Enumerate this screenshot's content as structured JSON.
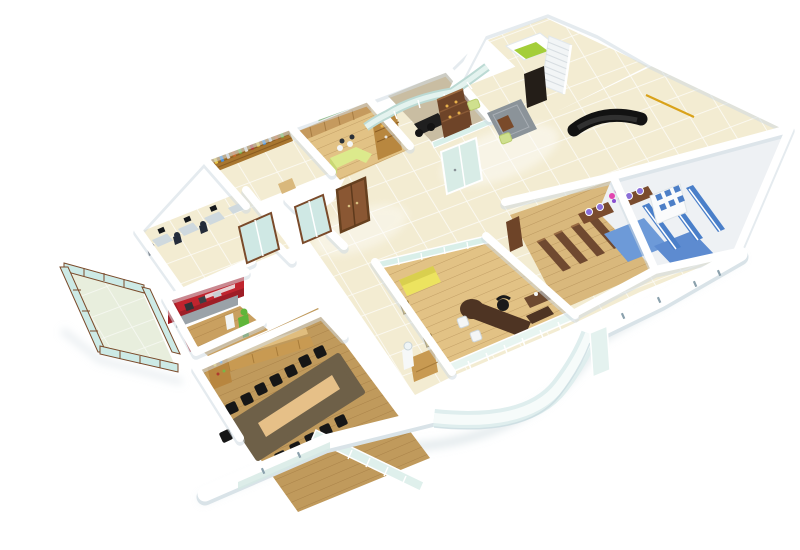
{
  "title": "3D Isometric Office Floor Plan Render",
  "scene": {
    "type": "architectural-3d-cutaway-floor-plan",
    "background": "#ffffff",
    "areas": [
      {
        "name": "entrance-lobby",
        "features": [
          "elevator",
          "staircase",
          "curved-glass-partition",
          "waiting-area",
          "black-curved-sofa",
          "display-cabinet"
        ]
      },
      {
        "name": "library-room",
        "features": [
          "bookshelf-wall",
          "bench"
        ]
      },
      {
        "name": "workstation-room",
        "features": [
          "three-computer-desks",
          "monitors",
          "seated-staff"
        ]
      },
      {
        "name": "reception-front-office",
        "features": [
          "wood-panel-wall",
          "green-signboard",
          "lime-reception-desk",
          "wooden-shelf"
        ]
      },
      {
        "name": "private-cabin",
        "features": [
          "black-desk",
          "wooden-cabinet",
          "frosted-glass-door"
        ]
      },
      {
        "name": "glass-terrace-balcony",
        "features": [
          "glass-panels",
          "brown-frames"
        ]
      },
      {
        "name": "red-pantry",
        "features": [
          "red-feature-wall",
          "gray-counter",
          "appliances",
          "green-figure",
          "water-cooler"
        ]
      },
      {
        "name": "conference-room",
        "features": [
          "long-table",
          "black-chairs",
          "wall-credenza",
          "glass-window-wall"
        ]
      },
      {
        "name": "manager-office",
        "features": [
          "curved-executive-desk",
          "black-chair",
          "white-guest-chairs",
          "yellow-sofa",
          "credenza",
          "wall-frames",
          "glass-partition",
          "window-band",
          "kitchenette"
        ]
      },
      {
        "name": "records-storage",
        "features": [
          "wardrobe-slabs",
          "wood-floor"
        ]
      },
      {
        "name": "restrooms",
        "features": [
          "wash-counters",
          "purple-basins",
          "blue-stall-partitions",
          "blue-floor",
          "cubby-shelf",
          "flower-decor"
        ]
      },
      {
        "name": "exterior-facade",
        "features": [
          "white-parapet-band",
          "curved-glass-atrium"
        ]
      }
    ]
  },
  "colors": {
    "wall": "#ffffff",
    "wallShadow": "#d0dbe1",
    "floorTile": "#f3ecd2",
    "sandFloor": "#e8eedd",
    "woodFloor": "#e2c285",
    "confFloor": "#c09a5c",
    "storageFloor": "#d9b87c",
    "cabinFloor": "#c9bda2",
    "redWall": "#c0242e",
    "redWallDark": "#9e1d26",
    "counterGray": "#9aa2a8",
    "elevatorGreen": "#a4ce39",
    "greenSign": "#4f9e2e",
    "limeDesk": "#dcea8c",
    "limeChair": "#cfe08e",
    "yellowSofa": "#ece35f",
    "blackSofa": "#121212",
    "goldTrim": "#d9a21a",
    "confTableOuter": "#6e6048",
    "confTableInner": "#e6c088",
    "chairBlack": "#161616",
    "credenza": "#c89a52",
    "bookshelf": "#a8762f",
    "shelfWood": "#b8873f",
    "woodWall": "#c59a5e",
    "glass": "#d8efe9",
    "glassCurve": "#bcdad4",
    "terraceGlass": "#cdeae6",
    "frameBrown": "#7a4a2a",
    "darkDesk": "#4e3423",
    "storageBrown": "#6f4930",
    "doorWood": "#8a5733",
    "cabinetDark": "#6e4428",
    "restroomBlue": "#6d9ad8",
    "restroomBlueDark": "#5d8bd0",
    "stallBlue": "#4a7fc9",
    "basinPurple": "#8a6fd8",
    "pinkFlower": "#e245b0",
    "greenFigure": "#5fb53a",
    "rugGray": "#8b9399",
    "personNavy": "#242c3a",
    "deskTop": "#cfd9de",
    "monitor": "#15181c",
    "whiteChair": "#f4f6f6"
  }
}
